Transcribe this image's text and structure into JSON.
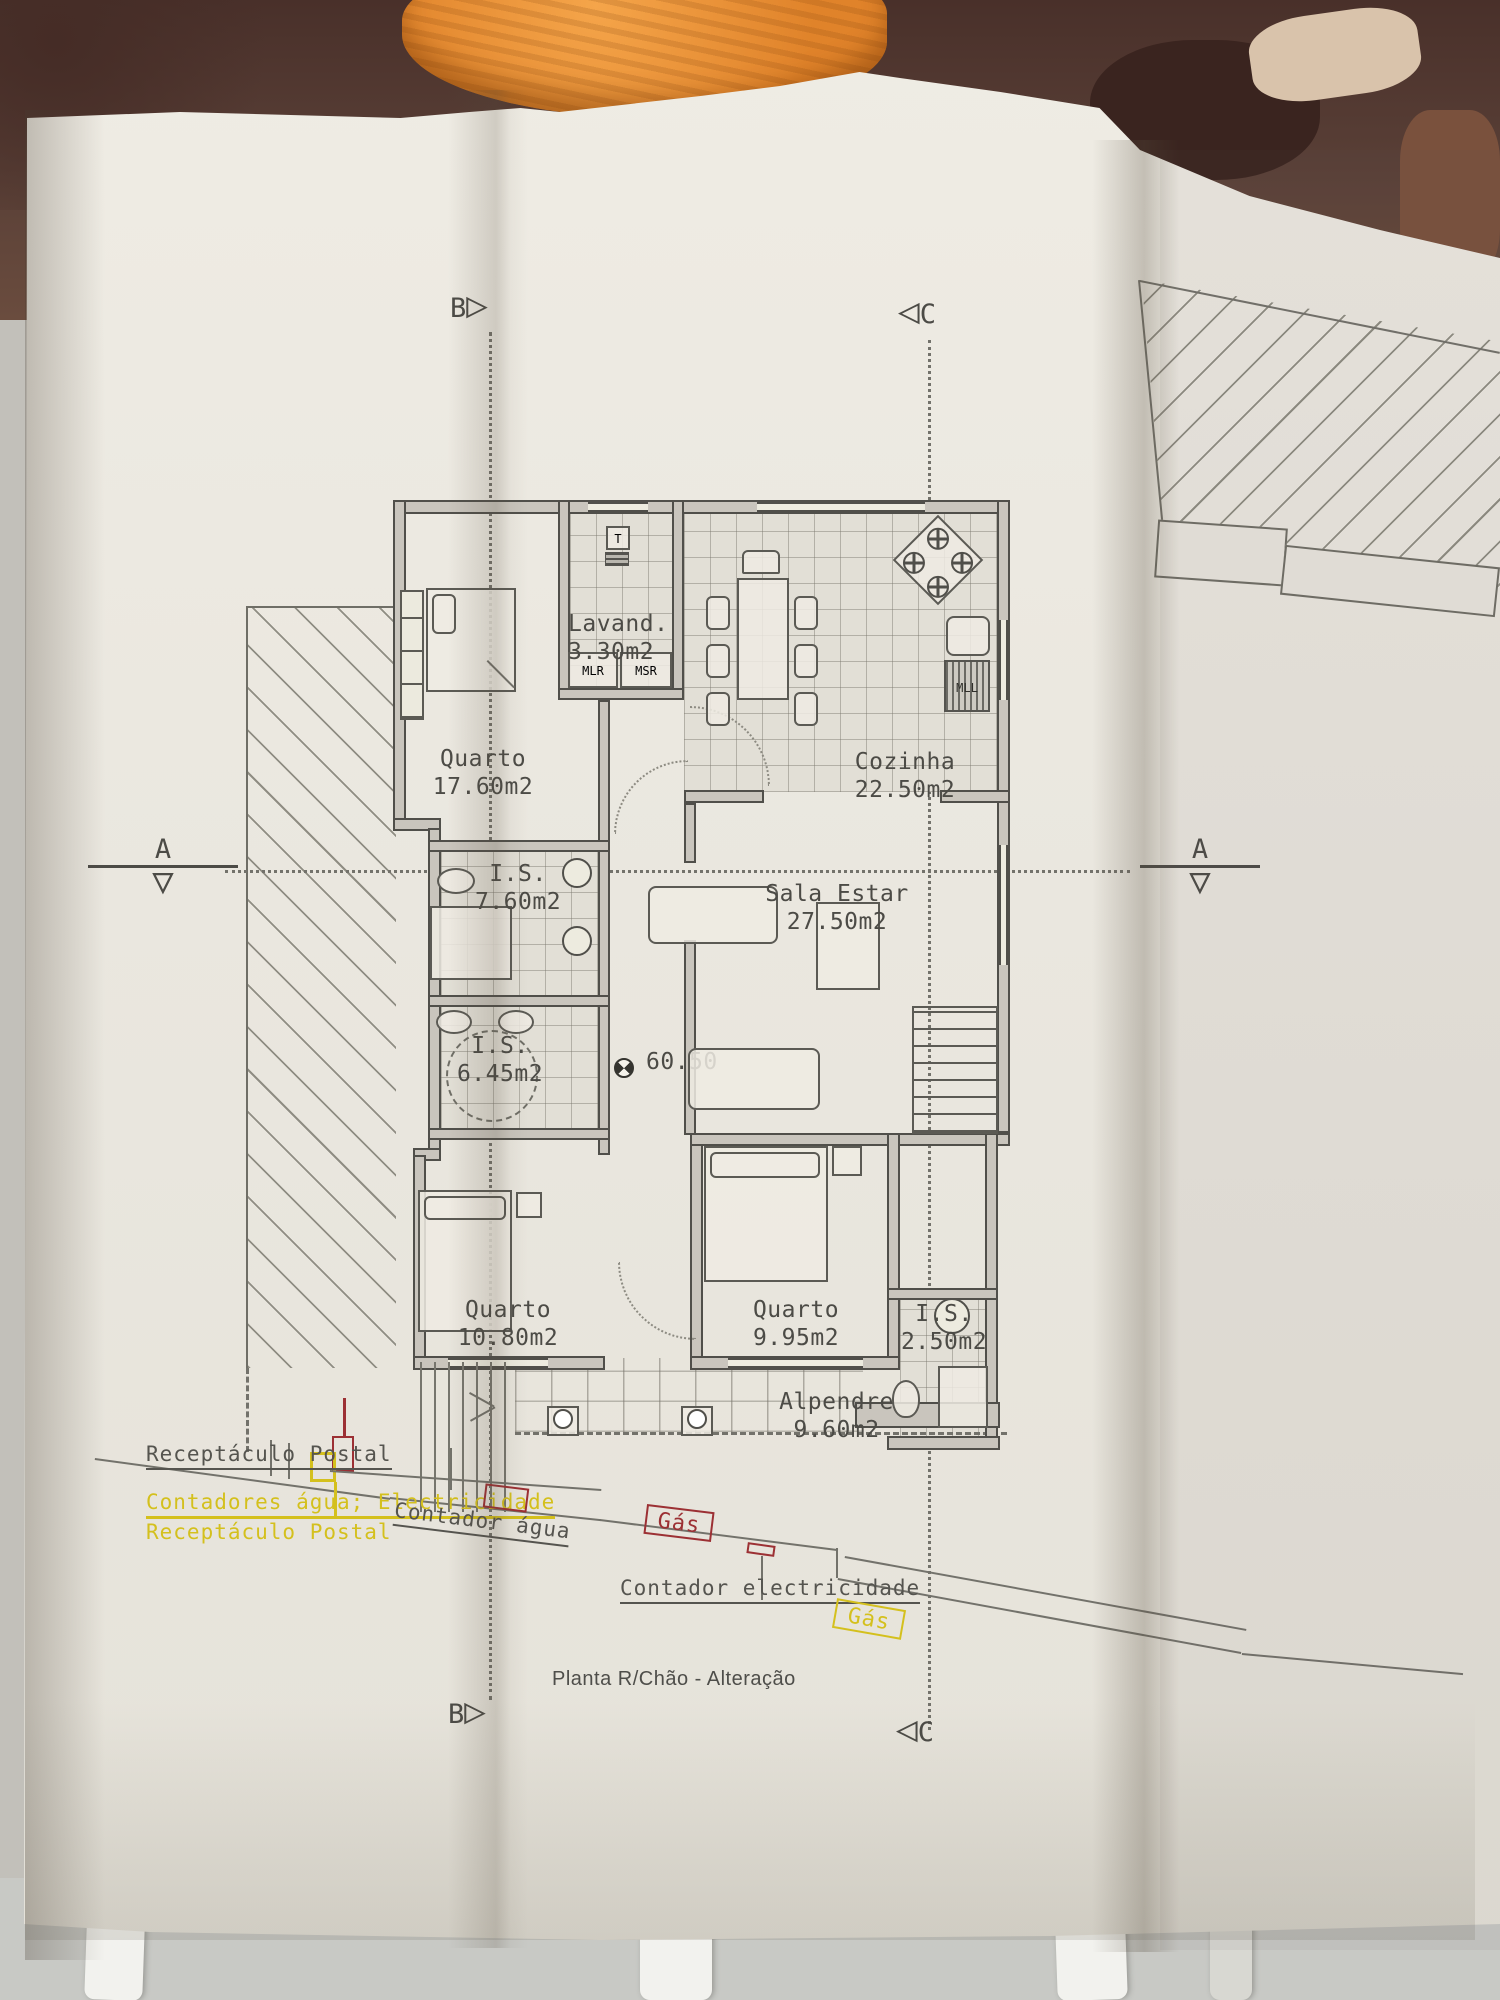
{
  "photo": {
    "scene": "architectural floor-plan sheet lying on a table",
    "colors": {
      "towel": "#e3873a",
      "table": "#5a4037",
      "paper": "#eae7df"
    }
  },
  "plan": {
    "title": "Planta R/Chão - Alteração",
    "level": "60.50",
    "sections": {
      "a": "A",
      "b": "B",
      "c": "C"
    },
    "icons": {
      "tri_right": "▷",
      "tri_left": "◁",
      "tri_down": "▽"
    },
    "rooms": [
      {
        "name": "Quarto",
        "area": "17.60m2"
      },
      {
        "name": "Lavand.",
        "area": "3.30m2"
      },
      {
        "name": "Cozinha",
        "area": "22.50m2"
      },
      {
        "name": "I.S.",
        "area": "7.60m2"
      },
      {
        "name": "Sala Estar",
        "area": "27.50m2"
      },
      {
        "name": "I.S.",
        "area": "6.45m2"
      },
      {
        "name": "Quarto",
        "area": "10.80m2"
      },
      {
        "name": "Quarto",
        "area": "9.95m2"
      },
      {
        "name": "I.S.",
        "area": "2.50m2"
      },
      {
        "name": "Alpendre",
        "area": "9.60m2"
      }
    ],
    "appliances": {
      "t": "T",
      "mlr": "MLR",
      "msr": "MSR",
      "mll": "MLL"
    },
    "annotations": {
      "receptaculo_postal": "Receptáculo Postal",
      "contadores": "Contadores água; Electricidade",
      "receptaculo_postal_2": "Receptáculo Postal",
      "contador_agua": "Contador água",
      "gas_1": "Gás",
      "contador_electricidade": "Contador electricidade",
      "gas_2": "Gás"
    },
    "annotation_colors": {
      "yellow": "#d4c01d",
      "red": "#9c3034",
      "ink": "#55544f"
    }
  }
}
